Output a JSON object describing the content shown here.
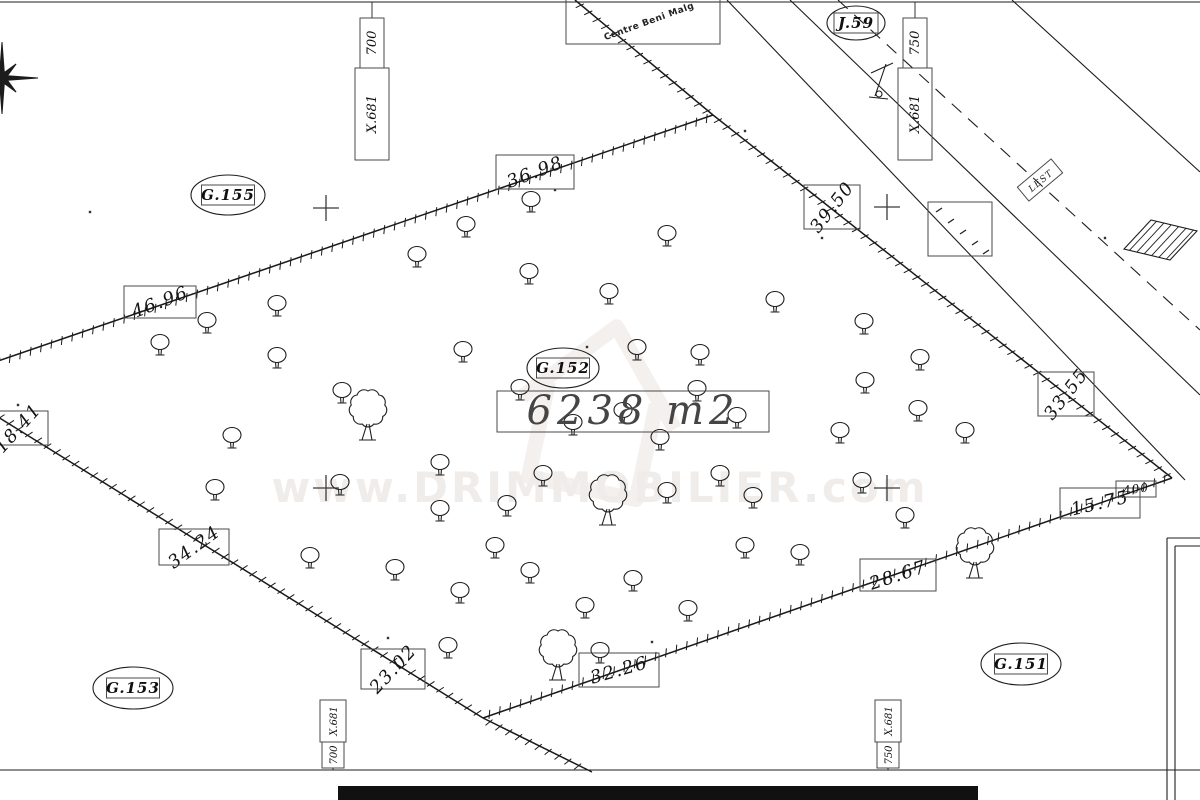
{
  "map": {
    "area_label": "6238 m2",
    "watermark": {
      "text": "www.DRIMMOBILIER.com"
    },
    "road_name": "Centre Beni Malg",
    "small_label": {
      "text": "LEST",
      "x": 1040,
      "y": 180,
      "rot": -40
    },
    "parcel_ids": [
      {
        "text": "G.155",
        "cx": 228,
        "cy": 195,
        "rx": 37,
        "ry": 20
      },
      {
        "text": "J.59",
        "cx": 856,
        "cy": 23,
        "rx": 29,
        "ry": 17
      },
      {
        "text": "G.152",
        "cx": 563,
        "cy": 368,
        "rx": 36,
        "ry": 20
      },
      {
        "text": "G.153",
        "cx": 133,
        "cy": 688,
        "rx": 40,
        "ry": 21
      },
      {
        "text": "G.151",
        "cx": 1021,
        "cy": 664,
        "rx": 40,
        "ry": 21
      }
    ],
    "dimensions": [
      {
        "text": "36.98",
        "cx": 535,
        "cy": 172,
        "rot": -21,
        "w": 78,
        "h": 34
      },
      {
        "text": "46.96",
        "cx": 160,
        "cy": 302,
        "rot": -21,
        "w": 72,
        "h": 32
      },
      {
        "text": "39.50",
        "cx": 832,
        "cy": 207,
        "rot": -52,
        "w": 56,
        "h": 44
      },
      {
        "text": "33.55",
        "cx": 1066,
        "cy": 394,
        "rot": -52,
        "w": 56,
        "h": 44
      },
      {
        "text": "18.41",
        "cx": 18,
        "cy": 428,
        "rot": -48,
        "w": 60,
        "h": 34
      },
      {
        "text": "34.24",
        "cx": 194,
        "cy": 547,
        "rot": -36,
        "w": 70,
        "h": 36
      },
      {
        "text": "23.02",
        "cx": 393,
        "cy": 669,
        "rot": -47,
        "w": 64,
        "h": 40
      },
      {
        "text": "32.26",
        "cx": 619,
        "cy": 670,
        "rot": -16,
        "w": 80,
        "h": 34
      },
      {
        "text": "28.67",
        "cx": 898,
        "cy": 575,
        "rot": -18,
        "w": 76,
        "h": 32
      },
      {
        "text": "15.75",
        "cx": 1100,
        "cy": 503,
        "rot": -13,
        "w": 80,
        "h": 30
      },
      {
        "text": "400",
        "cx": 1136,
        "cy": 489,
        "rot": -8,
        "w": 40,
        "h": 16,
        "small": true
      }
    ],
    "coordinates": [
      {
        "main": "X.681",
        "sub": "700",
        "x": 372,
        "edge": "top"
      },
      {
        "main": "X.681",
        "sub": "750",
        "x": 915,
        "edge": "top"
      },
      {
        "main": "X.681",
        "sub": "700",
        "x": 333,
        "edge": "bottom"
      },
      {
        "main": "X.681",
        "sub": "750",
        "x": 888,
        "edge": "bottom"
      }
    ],
    "geometry": {
      "parcel_edges": [
        [
          713,
          115,
          1172,
          478
        ],
        [
          1172,
          478,
          483,
          718
        ],
        [
          483,
          718,
          -60,
          381
        ],
        [
          -60,
          381,
          713,
          115
        ],
        [
          575,
          0,
          713,
          115
        ],
        [
          483,
          718,
          592,
          772
        ]
      ],
      "road_solid": [
        [
          727,
          0,
          1185,
          480
        ],
        [
          790,
          0,
          1200,
          395
        ],
        [
          1012,
          0,
          1200,
          172
        ]
      ],
      "road_dashed": [
        [
          838,
          0,
          1200,
          330
        ]
      ],
      "border_lines": [
        [
          0,
          2,
          1200,
          2
        ],
        [
          0,
          770,
          1200,
          770
        ]
      ],
      "structure_lines": [
        [
          1167,
          538,
          1167,
          800
        ],
        [
          1175,
          546,
          1175,
          800
        ],
        [
          1167,
          538,
          1200,
          538
        ],
        [
          1175,
          546,
          1200,
          546
        ]
      ],
      "building": [
        [
          1124,
          249
        ],
        [
          1151,
          220
        ],
        [
          1197,
          231
        ],
        [
          1170,
          260
        ]
      ],
      "crosses": [
        [
          326,
          208
        ],
        [
          887,
          207
        ],
        [
          326,
          488
        ],
        [
          887,
          488
        ]
      ],
      "dots": [
        [
          555,
          190
        ],
        [
          822,
          238
        ],
        [
          587,
          347
        ],
        [
          652,
          642
        ],
        [
          388,
          638
        ],
        [
          18,
          405
        ],
        [
          1105,
          238
        ],
        [
          745,
          131
        ],
        [
          90,
          212
        ]
      ],
      "marks": [
        [
          939,
          210
        ],
        [
          951,
          221
        ],
        [
          963,
          232
        ],
        [
          975,
          243
        ],
        [
          986,
          252
        ]
      ],
      "marks_box": [
        928,
        202,
        64,
        54
      ],
      "trees_small": [
        [
          531,
          199
        ],
        [
          466,
          224
        ],
        [
          667,
          233
        ],
        [
          417,
          254
        ],
        [
          529,
          271
        ],
        [
          609,
          291
        ],
        [
          775,
          299
        ],
        [
          277,
          303
        ],
        [
          207,
          320
        ],
        [
          864,
          321
        ],
        [
          160,
          342
        ],
        [
          463,
          349
        ],
        [
          277,
          355
        ],
        [
          700,
          352
        ],
        [
          920,
          357
        ],
        [
          342,
          390
        ],
        [
          637,
          347
        ],
        [
          520,
          387
        ],
        [
          697,
          388
        ],
        [
          623,
          410
        ],
        [
          737,
          415
        ],
        [
          573,
          422
        ],
        [
          660,
          437
        ],
        [
          918,
          408
        ],
        [
          865,
          380
        ],
        [
          232,
          435
        ],
        [
          440,
          462
        ],
        [
          340,
          482
        ],
        [
          215,
          487
        ],
        [
          495,
          545
        ],
        [
          530,
          570
        ],
        [
          585,
          605
        ],
        [
          460,
          590
        ],
        [
          633,
          578
        ],
        [
          688,
          608
        ],
        [
          543,
          473
        ],
        [
          720,
          473
        ],
        [
          667,
          490
        ],
        [
          753,
          495
        ],
        [
          507,
          503
        ],
        [
          440,
          508
        ],
        [
          600,
          650
        ],
        [
          448,
          645
        ],
        [
          840,
          430
        ],
        [
          905,
          515
        ],
        [
          965,
          430
        ],
        [
          862,
          480
        ],
        [
          745,
          545
        ],
        [
          800,
          552
        ],
        [
          310,
          555
        ],
        [
          395,
          567
        ]
      ],
      "trees_big": [
        [
          368,
          408
        ],
        [
          608,
          493
        ],
        [
          558,
          648
        ],
        [
          975,
          546
        ]
      ]
    }
  }
}
